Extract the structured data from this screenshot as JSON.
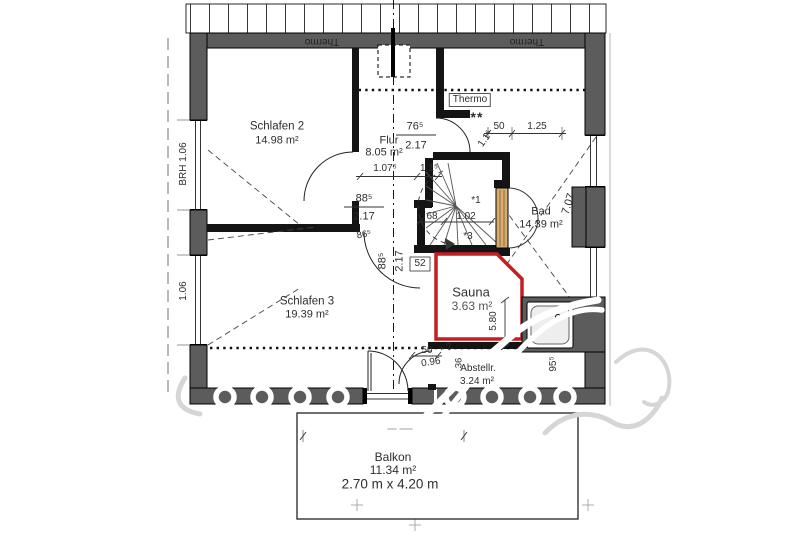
{
  "colors": {
    "wall": "#5c5c5c",
    "interior_wall": "#141414",
    "sauna_red": "#c41e23",
    "door_tan": "#d8ab6e"
  },
  "rooms": {
    "schlafen2": {
      "name": "Schlafen 2",
      "area": "14.98 m²"
    },
    "flur": {
      "name": "Flur",
      "area": "8.05 m²"
    },
    "bad": {
      "name": "Bad",
      "area": "14.39 m²"
    },
    "schlafen3": {
      "name": "Schlafen 3",
      "area": "19.39 m²"
    },
    "sauna": {
      "name": "Sauna",
      "area": "3.63 m²"
    },
    "abstellraum": {
      "name": "Abstellr.",
      "area": "3.24 m²"
    },
    "balkon": {
      "name": "Balkon",
      "area": "11.34 m²",
      "size": "2.70 m x 4.20 m"
    }
  },
  "dims": {
    "door_a_w": "76⁵",
    "door_a_h": "2.17",
    "door_b_w": "88⁵",
    "door_b_h": "2.17",
    "door_c_w": "88⁵",
    "door_c_h": "2.17",
    "flur_len": "1.07⁵",
    "seg_115a": "1.1⁵",
    "seg_115b": "1.1⁵",
    "seg_50": "50",
    "seg_125": "1.25",
    "bad_diag": "7.07",
    "stair_run_a": "68",
    "stair_run_b": "1.02",
    "seg_52": "52",
    "seg_096": "0.96",
    "seg_50b": "50",
    "sauna_len": "5.80",
    "seg_36": "36",
    "seg_955": "95⁵",
    "seg_865": "86⁵",
    "window_sill_left_top": "BRH 1.06",
    "window_sill_left_bottom": "1.06"
  },
  "annotations": {
    "thermo": "Thermo",
    "stars": "**",
    "note1": "*1",
    "note2": "* 2",
    "note3": "*3"
  }
}
